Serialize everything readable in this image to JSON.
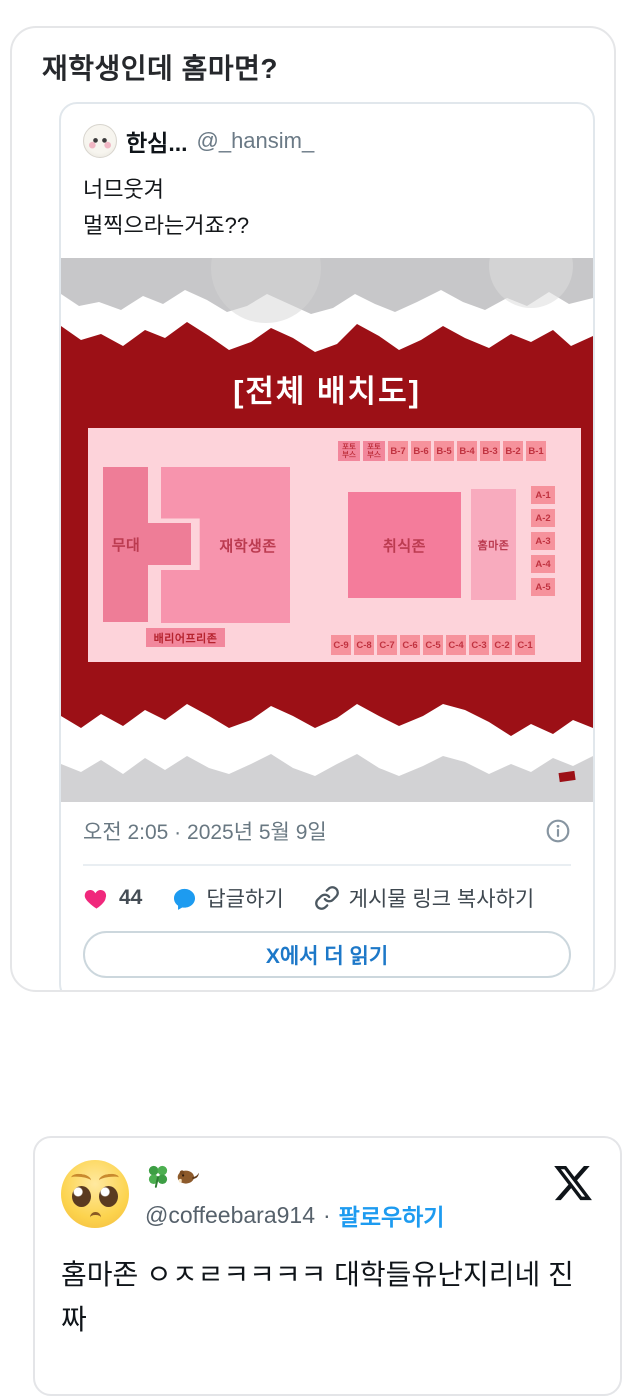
{
  "page": {
    "heading": "재학생인데 홈마면?"
  },
  "tweet1": {
    "display_name": "한심...",
    "handle": "@_hansim_",
    "body_lines": [
      "너므웃겨",
      "멀찍으라는거죠??"
    ],
    "timestamp": "오전 2:05 · 2025년 5월 9일",
    "like_count": "44",
    "reply_label": "답글하기",
    "copy_link_label": "게시물 링크 복사하기",
    "read_more_label": "X에서 더 읽기"
  },
  "diagram": {
    "title": "[전체 배치도]",
    "zones": {
      "stage": "무대",
      "students": "재학생존",
      "eating": "취식존",
      "homma": "홈마존",
      "barrier_free": "배리어프리존"
    },
    "photo_booth_line1": "포토",
    "photo_booth_line2": "부스",
    "b_row": [
      "B-7",
      "B-6",
      "B-5",
      "B-4",
      "B-3",
      "B-2",
      "B-1"
    ],
    "a_col": [
      "A-1",
      "A-2",
      "A-3",
      "A-4",
      "A-5"
    ],
    "c_row": [
      "C-9",
      "C-8",
      "C-7",
      "C-6",
      "C-5",
      "C-4",
      "C-3",
      "C-2",
      "C-1"
    ],
    "colors": {
      "poster_red": "#9c1016",
      "map_bg": "#fdd3da",
      "zone_dark_pink": "#ee7d97",
      "zone_pink": "#f794ad",
      "zone_light_pink": "#f8abbe",
      "box_salmon": "#f6929c",
      "box_text": "#c03340",
      "like_pink": "#f0287c",
      "reply_blue": "#1d9bf0",
      "read_more_blue": "#1d78c8"
    }
  },
  "link": {
    "arrow": "↓",
    "url": "https://x.com/coffeebara914/status/1920745572790595736?s=46&t=ppZlWEQ40VjjRGKGRonihA"
  },
  "tweet2": {
    "display_name_emojis": "🍀🦫",
    "handle": "@coffeebara914",
    "separator": "·",
    "follow_label": "팔로우하기",
    "body": "홈마존 ㅇㅈㄹㅋㅋㅋㅋ 대학들유난지리네 진짜"
  }
}
